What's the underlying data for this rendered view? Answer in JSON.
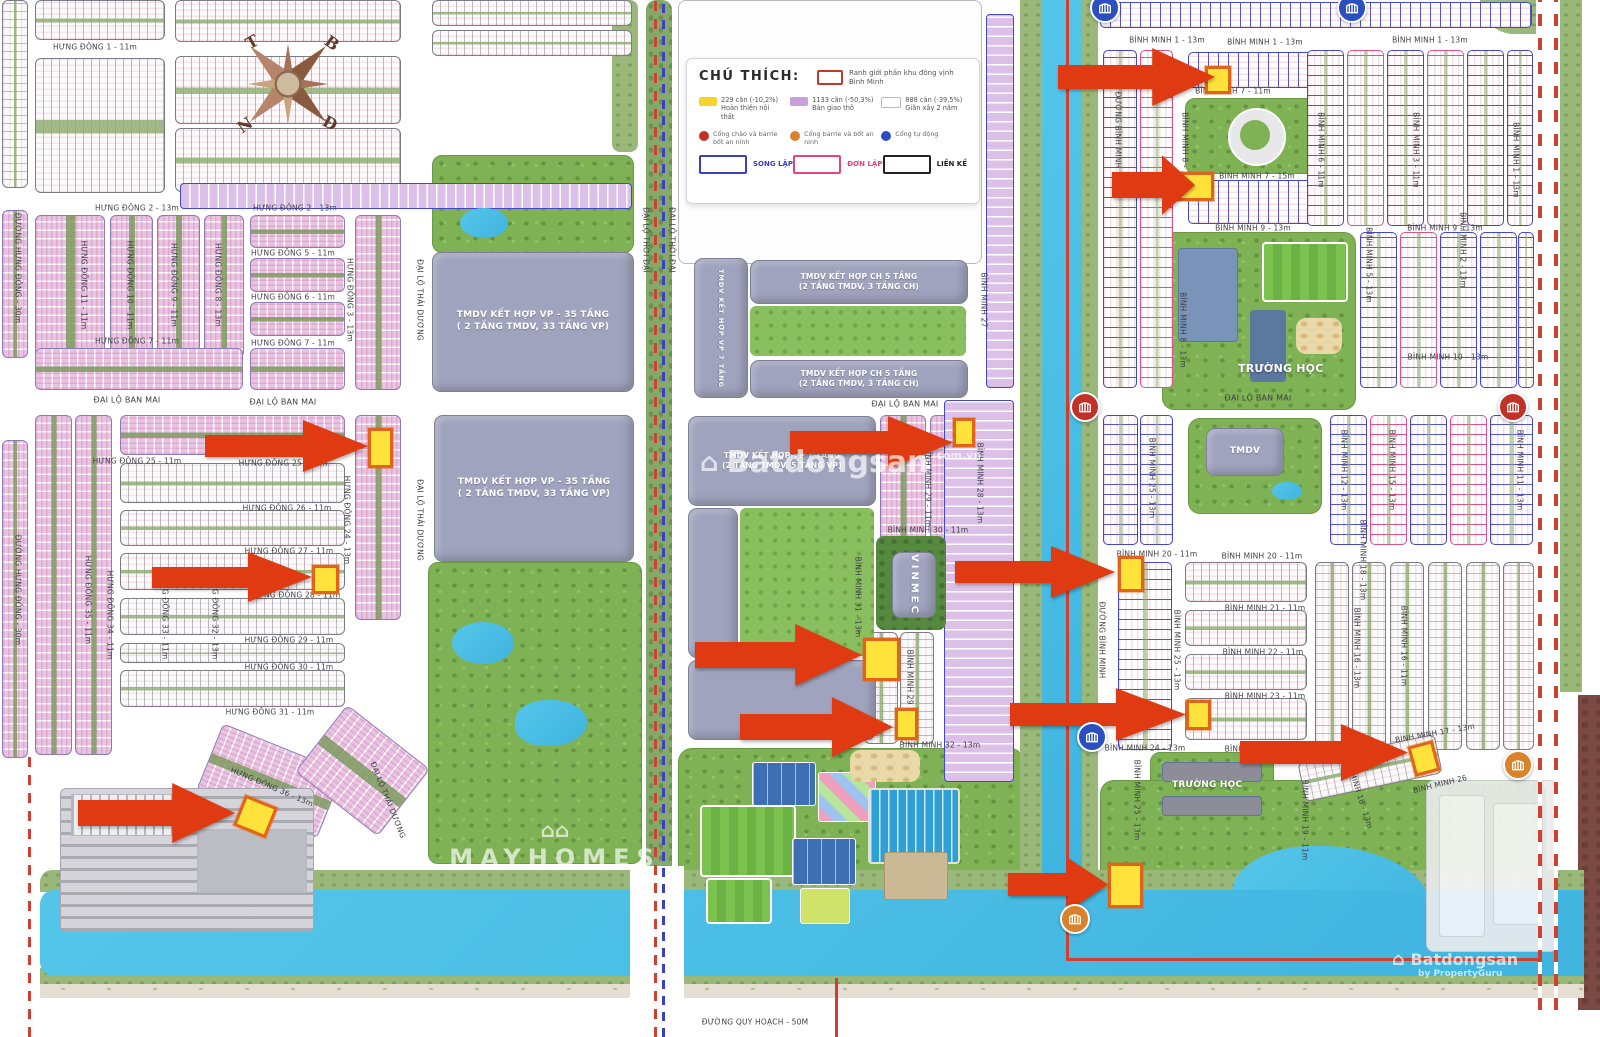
{
  "legend": {
    "title": "CHÚ THÍCH:",
    "boundary_label": "Ranh giới phân khu đông vịnh Bình Minh",
    "items": [
      {
        "line1": "229 căn (-10,2%)",
        "line2": "Hoàn thiện nội thất",
        "color": "#f6d32d"
      },
      {
        "line1": "1133 căn (-50,3%)",
        "line2": "Bàn giao thô",
        "color": "#c9a0dc"
      },
      {
        "line1": "888 căn (-39,5%)",
        "line2": "Giãn xây 2 năm",
        "color": "#ffffff"
      }
    ],
    "gates": [
      {
        "label": "Cổng chào và barrie bốt an ninh",
        "color": "#c23127"
      },
      {
        "label": "Cổng barrie và bốt an ninh",
        "color": "#d9822b"
      },
      {
        "label": "Cổng tự động",
        "color": "#2b4fc0"
      }
    ],
    "types": [
      {
        "label": "SONG LẬP",
        "color": "#3a41c5"
      },
      {
        "label": "ĐƠN LẬP",
        "color": "#e8437a"
      },
      {
        "label": "LIỀN KỀ",
        "color": "#222222"
      }
    ]
  },
  "buildings": {
    "tmdv35_line1": "TMDV KẾT HỢP VP - 35 TẦNG",
    "tmdv35_line2": "( 2 TẦNG TMDV, 33 TẦNG VP)",
    "ch5_line1": "TMDV KẾT HỢP  CH 5 TẦNG",
    "ch5_line2": "(2 TẦNG TMDV, 3 TẦNG CH)",
    "vp7_line1": "TMDV KẾT HỢP  VP 7 TẦNG",
    "vp7_line2": "(2 TẦNG TMDV, 5 TẦNG VP)",
    "vinmec": "VINMEC",
    "school": "TRƯỜNG HỌC",
    "tmdv": "TMDV"
  },
  "watermarks": {
    "center_text": "Batdongsan",
    "center_sub": "com.vn",
    "mayhomes": "MAYHOMES",
    "br_text": "Batdongsan",
    "br_sub": "by PropertyGuru"
  },
  "colors": {
    "highlight_yellow": "#ffe23a",
    "arrow_red": "#e03a12",
    "lot_purple": "#c9a0dc",
    "song_lap_blue": "#3a41c5",
    "don_lap_pink": "#e8437a",
    "lien_ke_black": "#222222",
    "boundary_red": "#d04030",
    "water_blue": "#4cc0e6",
    "park_green": "#7eb254"
  },
  "compass_letters": [
    {
      "t": "T",
      "x": 252,
      "y": 42,
      "r": -30
    },
    {
      "t": "B",
      "x": 332,
      "y": 43,
      "r": 35
    },
    {
      "t": "N",
      "x": 245,
      "y": 125,
      "r": -35
    },
    {
      "t": "Đ",
      "x": 330,
      "y": 123,
      "r": 28
    }
  ],
  "streets": [
    {
      "t": "HƯNG ĐÔNG 1 - 11m",
      "x": 95,
      "y": 47
    },
    {
      "t": "HƯNG ĐÔNG 2 - 13m",
      "x": 137,
      "y": 208
    },
    {
      "t": "HƯNG ĐÔNG 2 - 13m",
      "x": 295,
      "y": 208
    },
    {
      "t": "HƯNG ĐÔNG 5 - 11m",
      "x": 293,
      "y": 253
    },
    {
      "t": "HƯNG ĐÔNG 6 - 11m",
      "x": 293,
      "y": 297
    },
    {
      "t": "HƯNG ĐÔNG 7 - 11m",
      "x": 137,
      "y": 341
    },
    {
      "t": "HƯNG ĐÔNG 7 - 11m",
      "x": 293,
      "y": 343
    },
    {
      "t": "ĐƯỜNG HƯNG ĐÔNG - 30m",
      "x": 18,
      "y": 268,
      "r": 90
    },
    {
      "t": "HƯNG ĐÔNG 11 - 11m",
      "x": 84,
      "y": 285,
      "r": 90
    },
    {
      "t": "HƯNG ĐÔNG 10 - 11m",
      "x": 130,
      "y": 285,
      "r": 90
    },
    {
      "t": "HƯNG ĐÔNG 9 - 11m",
      "x": 174,
      "y": 285,
      "r": 90
    },
    {
      "t": "HƯNG ĐÔNG 8 - 13m",
      "x": 218,
      "y": 285,
      "r": 90
    },
    {
      "t": "HƯNG ĐÔNG 3 - 13m",
      "x": 350,
      "y": 300,
      "r": 90
    },
    {
      "t": "ĐẠI LỘ BAN MAI",
      "x": 127,
      "y": 400,
      "fs": 8
    },
    {
      "t": "ĐẠI LỘ BAN MAI",
      "x": 283,
      "y": 402,
      "fs": 8
    },
    {
      "t": "HƯNG ĐÔNG 25 - 11m",
      "x": 137,
      "y": 461
    },
    {
      "t": "HƯNG ĐÔNG 25 - 11m",
      "x": 283,
      "y": 463
    },
    {
      "t": "HƯNG ĐÔNG 26 - 11m",
      "x": 287,
      "y": 508
    },
    {
      "t": "HƯNG ĐÔNG 27 - 11m",
      "x": 289,
      "y": 551
    },
    {
      "t": "HƯNG ĐÔNG 28 - 11m",
      "x": 296,
      "y": 595
    },
    {
      "t": "HƯNG ĐÔNG 29 - 11m",
      "x": 289,
      "y": 640
    },
    {
      "t": "HƯNG ĐÔNG 30 - 11m",
      "x": 289,
      "y": 667
    },
    {
      "t": "HƯNG ĐÔNG 31 - 11m",
      "x": 270,
      "y": 712
    },
    {
      "t": "ĐƯỜNG HƯNG ĐÔNG - 30m",
      "x": 18,
      "y": 590,
      "r": 90
    },
    {
      "t": "HƯNG ĐÔNG 35 - 11m",
      "x": 88,
      "y": 600,
      "r": 90
    },
    {
      "t": "HƯNG ĐÔNG 34 - 11m",
      "x": 110,
      "y": 615,
      "r": 90
    },
    {
      "t": "HƯNG ĐÔNG 33 - 11m",
      "x": 165,
      "y": 615,
      "r": 90
    },
    {
      "t": "HƯNG ĐÔNG 32 - 13m",
      "x": 215,
      "y": 615,
      "r": 90
    },
    {
      "t": "HƯNG ĐÔNG 24 - 13m",
      "x": 347,
      "y": 520,
      "r": 90
    },
    {
      "t": "HƯNG ĐÔNG 36 - 13m",
      "x": 272,
      "y": 787,
      "r": 23
    },
    {
      "t": "ĐẠI LỘ THÁI DƯƠNG",
      "x": 420,
      "y": 300,
      "r": 90
    },
    {
      "t": "ĐẠI LỘ THÁI DƯƠNG",
      "x": 420,
      "y": 520,
      "r": 90
    },
    {
      "t": "ĐẠI LỘ THÁI DƯƠNG",
      "x": 388,
      "y": 800,
      "r": 68
    },
    {
      "t": "ĐẠI LỘ THỜI ĐẠI",
      "x": 646,
      "y": 240,
      "r": 90
    },
    {
      "t": "ĐẠI LỘ THỜI ĐẠI",
      "x": 672,
      "y": 240,
      "r": 90
    },
    {
      "t": "ĐƯỜNG QUY HOẠCH - 50M",
      "x": 755,
      "y": 1022
    },
    {
      "t": "ĐẠI LỘ BAN MAI",
      "x": 905,
      "y": 404,
      "fs": 8
    },
    {
      "t": "BÌNH MINH 27",
      "x": 984,
      "y": 300,
      "r": 90
    },
    {
      "t": "BÌNH MINH 29 - 11m",
      "x": 928,
      "y": 487,
      "r": 90
    },
    {
      "t": "BÌNH MINH 28 - 13m",
      "x": 980,
      "y": 483,
      "r": 90
    },
    {
      "t": "BÌNH MINH 30 - 11m",
      "x": 928,
      "y": 530
    },
    {
      "t": "BÌNH MINH 31 - 13m",
      "x": 858,
      "y": 597,
      "r": 90
    },
    {
      "t": "BÌNH MINH 29 - 11m",
      "x": 910,
      "y": 690,
      "r": 90
    },
    {
      "t": "BÌNH MINH 32 - 13m",
      "x": 940,
      "y": 745
    },
    {
      "t": "ĐƯỜNG BÌNH MINH",
      "x": 1118,
      "y": 130,
      "r": 90
    },
    {
      "t": "ĐƯỜNG BÌNH MINH",
      "x": 1102,
      "y": 640,
      "r": 90
    },
    {
      "t": "BÌNH MINH 1 - 13m",
      "x": 1167,
      "y": 40
    },
    {
      "t": "BÌNH MINH 1 - 13m",
      "x": 1265,
      "y": 42
    },
    {
      "t": "BÌNH MINH 1 - 13m",
      "x": 1430,
      "y": 40
    },
    {
      "t": "BÌNH MINH 7 - 11m",
      "x": 1233,
      "y": 91
    },
    {
      "t": "BÌNH MINH 7 - 15m",
      "x": 1257,
      "y": 176
    },
    {
      "t": "BÌNH MINH 8 - 13m",
      "x": 1185,
      "y": 150,
      "r": 90
    },
    {
      "t": "BÌNH MINH 8 - 13m",
      "x": 1183,
      "y": 330,
      "r": 90
    },
    {
      "t": "BÌNH MINH 9 - 13m",
      "x": 1253,
      "y": 228
    },
    {
      "t": "BÌNH MINH 9 - 13m",
      "x": 1445,
      "y": 228
    },
    {
      "t": "BÌNH MINH 6 - 11m",
      "x": 1321,
      "y": 150,
      "r": 90
    },
    {
      "t": "BÌNH MINH 5 - 13m",
      "x": 1369,
      "y": 265,
      "r": 90
    },
    {
      "t": "BÌNH MINH 3 - 11m",
      "x": 1416,
      "y": 150,
      "r": 90
    },
    {
      "t": "BÌNH MINH 2 - 13m",
      "x": 1463,
      "y": 250,
      "r": 90
    },
    {
      "t": "BÌNH MINH 1 - 13m",
      "x": 1516,
      "y": 160,
      "r": 90
    },
    {
      "t": "BÌNH MINH 10 - 13m",
      "x": 1448,
      "y": 357
    },
    {
      "t": "ĐẠI LỘ BAN MAI",
      "x": 1258,
      "y": 398,
      "fs": 8
    },
    {
      "t": "BÌNH MINH 25 - 13m",
      "x": 1152,
      "y": 478,
      "r": 90
    },
    {
      "t": "BÌNH MINH 12 - 13m",
      "x": 1344,
      "y": 470,
      "r": 90
    },
    {
      "t": "BÌNH MINH 15 - 13m",
      "x": 1392,
      "y": 470,
      "r": 90
    },
    {
      "t": "BÌNH MINH 11 - 13m",
      "x": 1520,
      "y": 470,
      "r": 90
    },
    {
      "t": "BÌNH MINH 20 - 11m",
      "x": 1157,
      "y": 554
    },
    {
      "t": "BÌNH MINH 20 - 11m",
      "x": 1262,
      "y": 556
    },
    {
      "t": "BÌNH MINH 21 - 11m",
      "x": 1265,
      "y": 608
    },
    {
      "t": "BÌNH MINH 22 - 11m",
      "x": 1263,
      "y": 652
    },
    {
      "t": "BÌNH MINH 23 - 11m",
      "x": 1265,
      "y": 696
    },
    {
      "t": "BÌNH MINH 24 - 13m",
      "x": 1145,
      "y": 748
    },
    {
      "t": "BÌNH MINH 24 - 13m",
      "x": 1265,
      "y": 749
    },
    {
      "t": "BÌNH MINH 25 - 13m",
      "x": 1177,
      "y": 650,
      "r": 90
    },
    {
      "t": "BÌNH MINH 16 - 13m",
      "x": 1357,
      "y": 648,
      "r": 90
    },
    {
      "t": "BÌNH MINH 16 - 11m",
      "x": 1404,
      "y": 646,
      "r": 90
    },
    {
      "t": "BÌNH MINH 18 - 13m",
      "x": 1363,
      "y": 560,
      "r": 90
    },
    {
      "t": "BÌNH MINH 17 - 13m",
      "x": 1435,
      "y": 733,
      "r": -10
    },
    {
      "t": "BÌNH MINH 26",
      "x": 1440,
      "y": 784,
      "r": -14
    },
    {
      "t": "BÌNH MINH 19 - 11m",
      "x": 1305,
      "y": 820,
      "r": 90
    },
    {
      "t": "BÌNH MINH 18 - 13m",
      "x": 1358,
      "y": 790,
      "r": 72
    },
    {
      "t": "BÌNH MINH 25 - 13m",
      "x": 1137,
      "y": 800,
      "r": 90
    }
  ],
  "arrows": [
    {
      "x": 1058,
      "y": 48,
      "w": 157,
      "h": 58
    },
    {
      "x": 1112,
      "y": 155,
      "w": 83,
      "h": 60
    },
    {
      "x": 205,
      "y": 420,
      "w": 163,
      "h": 52
    },
    {
      "x": 152,
      "y": 552,
      "w": 160,
      "h": 50
    },
    {
      "x": 790,
      "y": 416,
      "w": 163,
      "h": 53
    },
    {
      "x": 955,
      "y": 546,
      "w": 160,
      "h": 52
    },
    {
      "x": 695,
      "y": 624,
      "w": 167,
      "h": 62
    },
    {
      "x": 740,
      "y": 697,
      "w": 153,
      "h": 60
    },
    {
      "x": 1010,
      "y": 688,
      "w": 176,
      "h": 53
    },
    {
      "x": 1240,
      "y": 724,
      "w": 168,
      "h": 57
    },
    {
      "x": 78,
      "y": 783,
      "w": 157,
      "h": 60
    },
    {
      "x": 1008,
      "y": 858,
      "w": 100,
      "h": 53
    }
  ],
  "highlights": [
    {
      "x": 1205,
      "y": 66,
      "w": 26,
      "h": 28
    },
    {
      "x": 1168,
      "y": 172,
      "w": 46,
      "h": 29
    },
    {
      "x": 368,
      "y": 428,
      "w": 25,
      "h": 40
    },
    {
      "x": 312,
      "y": 565,
      "w": 27,
      "h": 29
    },
    {
      "x": 953,
      "y": 418,
      "w": 22,
      "h": 29
    },
    {
      "x": 1118,
      "y": 556,
      "w": 26,
      "h": 36
    },
    {
      "x": 863,
      "y": 638,
      "w": 37,
      "h": 43
    },
    {
      "x": 895,
      "y": 708,
      "w": 23,
      "h": 32
    },
    {
      "x": 1186,
      "y": 700,
      "w": 25,
      "h": 30
    },
    {
      "x": 1411,
      "y": 743,
      "w": 26,
      "h": 31,
      "r": -15
    },
    {
      "x": 238,
      "y": 800,
      "w": 35,
      "h": 33,
      "r": 22
    },
    {
      "x": 1108,
      "y": 863,
      "w": 35,
      "h": 45
    }
  ],
  "gates": [
    {
      "x": 1105,
      "y": 8,
      "c": "g-blue"
    },
    {
      "x": 1352,
      "y": 8,
      "c": "g-blue"
    },
    {
      "x": 1085,
      "y": 407,
      "c": "g-red"
    },
    {
      "x": 1513,
      "y": 407,
      "c": "g-red"
    },
    {
      "x": 1092,
      "y": 737,
      "c": "g-blue"
    },
    {
      "x": 1518,
      "y": 765,
      "c": "g-orange"
    },
    {
      "x": 1075,
      "y": 919,
      "c": "g-orange"
    }
  ]
}
